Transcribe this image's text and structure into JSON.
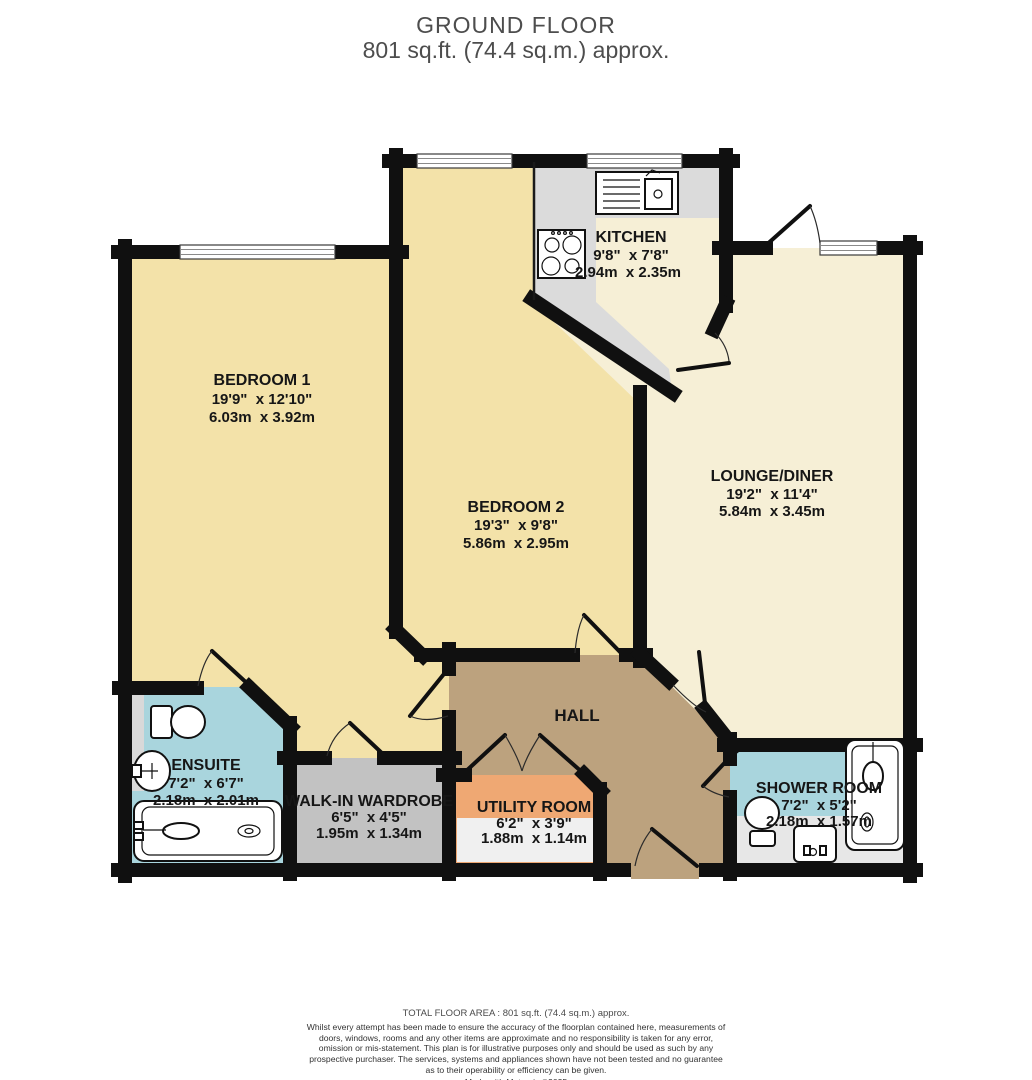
{
  "title": {
    "line1": "GROUND FLOOR",
    "line2": "801 sq.ft. (74.4 sq.m.) approx."
  },
  "rooms": {
    "bedroom1": {
      "name": "BEDROOM 1",
      "imperial": "19'9\"  x 12'10\"",
      "metric": "6.03m  x 3.92m"
    },
    "bedroom2": {
      "name": "BEDROOM 2",
      "imperial": "19'3\"  x 9'8\"",
      "metric": "5.86m  x 2.95m"
    },
    "kitchen": {
      "name": "KITCHEN",
      "imperial": "9'8\"  x 7'8\"",
      "metric": "2.94m  x 2.35m"
    },
    "lounge": {
      "name": "LOUNGE/DINER",
      "imperial": "19'2\"  x 11'4\"",
      "metric": "5.84m  x 3.45m"
    },
    "hall": {
      "name": "HALL"
    },
    "ensuite": {
      "name": "ENSUITE",
      "imperial": "7'2\"  x 6'7\"",
      "metric": "2.18m  x 2.01m"
    },
    "wardrobe": {
      "name": "WALK-IN WARDROBE",
      "imperial": "6'5\"  x 4'5\"",
      "metric": "1.95m  x 1.34m"
    },
    "utility": {
      "name": "UTILITY ROOM",
      "imperial": "6'2\"  x 3'9\"",
      "metric": "1.88m  x 1.14m"
    },
    "shower": {
      "name": "SHOWER ROOM",
      "imperial": "7'2\"  x 5'2\"",
      "metric": "2.18m  x 1.57m"
    }
  },
  "footer": {
    "total": "TOTAL FLOOR AREA : 801 sq.ft. (74.4 sq.m.) approx.",
    "disclaimer": "Whilst every attempt has been made to ensure the accuracy of the floorplan contained here, measurements of doors, windows, rooms and any other items are approximate and no responsibility is taken for any error, omission or mis-statement. This plan is for illustrative purposes only and should be used as such by any prospective purchaser. The services, systems and appliances shown have not been tested and no guarantee as to their operability or efficiency can be given.",
    "credit": "Made with Metropix ©2025"
  },
  "colors": {
    "bedroom_fill": "#F3E2A9",
    "lounge_kitchen_fill": "#F6EFD6",
    "hall_fill": "#BCA27E",
    "bathroom_fill": "#A9D5DD",
    "wardrobe_fill": "#C2C2C2",
    "utility_fill": "#EFA873",
    "counter_gray": "#DBDBDB",
    "wall": "#101010",
    "title_text": "#4D4D4D"
  }
}
